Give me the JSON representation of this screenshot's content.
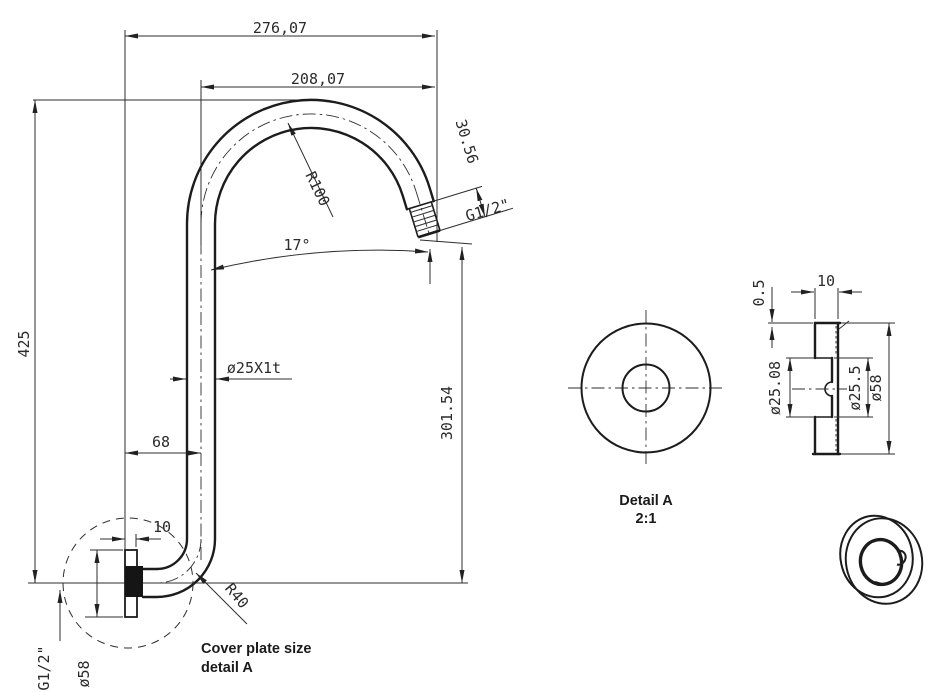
{
  "title": "Shower arm technical drawing",
  "colors": {
    "line": "#1c1c1c",
    "background": "#ffffff"
  },
  "main_view": {
    "dim_overall_width": "276,07",
    "dim_arc_width": "208,07",
    "dim_overall_height": "425",
    "dim_outlet_length": "30.56",
    "outlet_thread_label": "G1/2\"",
    "dim_main_radius": "R100",
    "dim_outlet_angle": "17°",
    "pipe_spec_label": "ø25X1t",
    "dim_outlet_height": "301.54",
    "dim_wall_offset": "68",
    "dim_plate_thickness": "10",
    "dim_bend_radius": "R40",
    "inlet_thread_label": "G1/2\"",
    "dim_plate_diameter": "ø58",
    "note_line1": "Cover plate size",
    "note_line2": "detail A"
  },
  "detail_view": {
    "title": "Detail A",
    "scale": "2:1",
    "dim_lip": "0.5",
    "dim_depth": "10",
    "dim_bore_back": "ø25.08",
    "dim_bore_front": "ø25.5",
    "dim_outer_diameter": "ø58"
  }
}
